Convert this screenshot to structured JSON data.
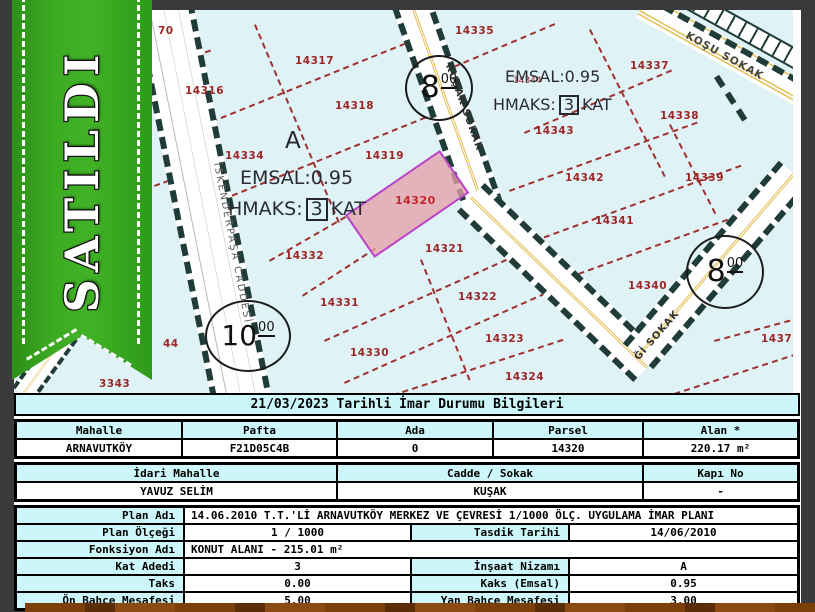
{
  "ribbon": {
    "label": "SATILDI",
    "color": "#3aa622"
  },
  "map": {
    "parcels": [
      {
        "n": "70",
        "x": 144,
        "y": 15
      },
      {
        "n": "14335",
        "x": 441,
        "y": 15
      },
      {
        "n": "14317",
        "x": 281,
        "y": 45
      },
      {
        "n": "14316",
        "x": 171,
        "y": 75
      },
      {
        "n": "14318",
        "x": 321,
        "y": 90
      },
      {
        "n": "14337",
        "x": 616,
        "y": 50
      },
      {
        "n": "14343",
        "x": 521,
        "y": 115
      },
      {
        "n": "14338",
        "x": 646,
        "y": 100
      },
      {
        "n": "14334",
        "x": 211,
        "y": 140
      },
      {
        "n": "14319",
        "x": 351,
        "y": 140
      },
      {
        "n": "14342",
        "x": 551,
        "y": 162
      },
      {
        "n": "14339",
        "x": 671,
        "y": 162
      },
      {
        "n": "14341",
        "x": 581,
        "y": 205
      },
      {
        "n": "14321",
        "x": 411,
        "y": 233
      },
      {
        "n": "14332",
        "x": 271,
        "y": 240
      },
      {
        "n": "14340",
        "x": 614,
        "y": 270
      },
      {
        "n": "14331",
        "x": 306,
        "y": 287
      },
      {
        "n": "14322",
        "x": 444,
        "y": 281
      },
      {
        "n": "14323",
        "x": 471,
        "y": 323
      },
      {
        "n": "14330",
        "x": 336,
        "y": 337
      },
      {
        "n": "14324",
        "x": 491,
        "y": 361
      },
      {
        "n": "14373",
        "x": 747,
        "y": 323
      },
      {
        "n": "44",
        "x": 149,
        "y": 328
      },
      {
        "n": "3343",
        "x": 85,
        "y": 368
      }
    ],
    "highlight_parcel": {
      "number": "14320",
      "fill": "#e8aab2",
      "border": "#b944c8"
    },
    "obscured_parcel": "14344",
    "block_label": "A",
    "zone_left": {
      "emsal": "EMSAL:0.95",
      "hmaks_pre": "HMAKS:",
      "floors": "3",
      "hmaks_post": "KAT"
    },
    "zone_right": {
      "emsal": "EMSAL:0.95",
      "hmaks_pre": "HMAKS:",
      "floors": "3",
      "hmaks_post": "KAT"
    },
    "width_circles": [
      {
        "main": "8",
        "sup": "00"
      },
      {
        "main": "8",
        "sup": "00"
      },
      {
        "main": "10",
        "sup": "00"
      }
    ],
    "streets": {
      "kusak": "KUŞAK SOKAK",
      "iskenderpasa": "İSKENDERPAŞA CADDESİ",
      "kosu": "KOŞU SOKAK",
      "gi": "Ğİ SOKAK"
    }
  },
  "table": {
    "title": "21/03/2023 Tarihli İmar Durumu Bilgileri",
    "group1": {
      "headers": [
        "Mahalle",
        "Pafta",
        "Ada",
        "Parsel",
        "Alan *"
      ],
      "values": [
        "ARNAVUTKÖY",
        "F21D05C4B",
        "0",
        "14320",
        "220.17 m²"
      ]
    },
    "group2": {
      "headers": [
        "İdari Mahalle",
        "Cadde / Sokak",
        "Kapı No"
      ],
      "values": [
        "YAVUZ SELİM",
        "KUŞAK",
        "-"
      ]
    },
    "rows": [
      {
        "label": "Plan Adı",
        "value": "14.06.2010 T.T.'Lİ ARNAVUTKÖY MERKEZ VE ÇEVRESİ 1/1000 ÖLÇ. UYGULAMA İMAR PLANI",
        "full": true
      },
      {
        "label": "Plan Ölçeği",
        "value": "1 / 1000",
        "label2": "Tasdik Tarihi",
        "value2": "14/06/2010"
      },
      {
        "label": "Fonksiyon Adı",
        "value": "KONUT ALANI  - 215.01 m²",
        "full": true
      },
      {
        "label": "Kat Adedi",
        "value": "3",
        "label2": "İnşaat Nizamı",
        "value2": "A"
      },
      {
        "label": "Taks",
        "value": "0.00",
        "label2": "Kaks (Emsal)",
        "value2": "0.95"
      },
      {
        "label": "Ön Bahçe Mesafesi",
        "value": "5.00",
        "label2": "Yan Bahçe Mesafesi",
        "value2": "3.00"
      }
    ]
  }
}
